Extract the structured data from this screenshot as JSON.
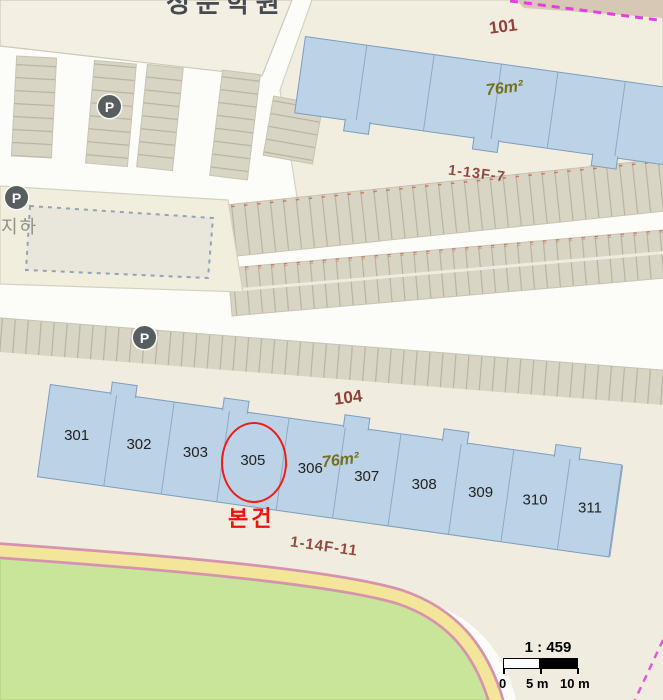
{
  "top_block": {
    "label": "성문학원"
  },
  "building_101": {
    "number": "101",
    "area_label": "76m²"
  },
  "parking": {
    "p_label": "P",
    "underground_label": "지하"
  },
  "lots": {
    "upper": "1-13F-7",
    "lower": "1-14F-11"
  },
  "building_104": {
    "number": "104",
    "area_label": "76m²",
    "units": [
      "301",
      "302",
      "303",
      "305",
      "306",
      "307",
      "308",
      "309",
      "310",
      "311"
    ]
  },
  "subject": {
    "unit": "305",
    "label": "본건"
  },
  "scale_bar": {
    "ratio": "1 : 459",
    "tick_0": "0",
    "tick_5": "5 m",
    "tick_10": "10 m"
  },
  "colors": {
    "building_fill": "#bcd2e6",
    "building_border": "#7e9fbe",
    "subject_red": "#ee1c16",
    "label_brown": "#8d4137",
    "area_olive": "#75701d",
    "road_yellow": "#f3e69b",
    "green_area": "#c9e59a",
    "boundary_magenta": "#e23ee0"
  }
}
